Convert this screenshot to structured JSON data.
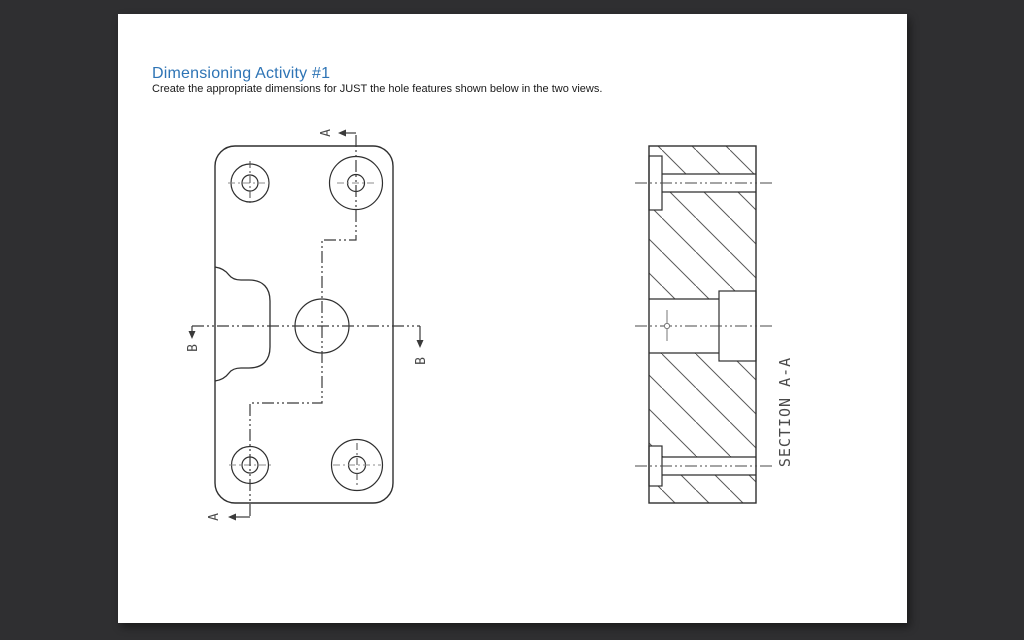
{
  "document": {
    "title": "Dimensioning Activity #1",
    "subtitle": "Create the appropriate dimensions for JUST the hole features shown below in the two views."
  },
  "plan_view": {
    "cut_label_a_top": "A",
    "cut_label_a_bottom": "A",
    "cut_label_b_left": "B",
    "cut_label_b_right": "B"
  },
  "section_view": {
    "caption": "SECTION A-A"
  },
  "colors": {
    "window_background": "#2f2f31",
    "paper": "#ffffff",
    "title_blue": "#2e74b5",
    "drawing_line": "#2f2f2f",
    "cutting_line": "#3a3a3a",
    "centerline_gray": "#8c8c8c",
    "hatch_gray": "#5a5a5a"
  }
}
